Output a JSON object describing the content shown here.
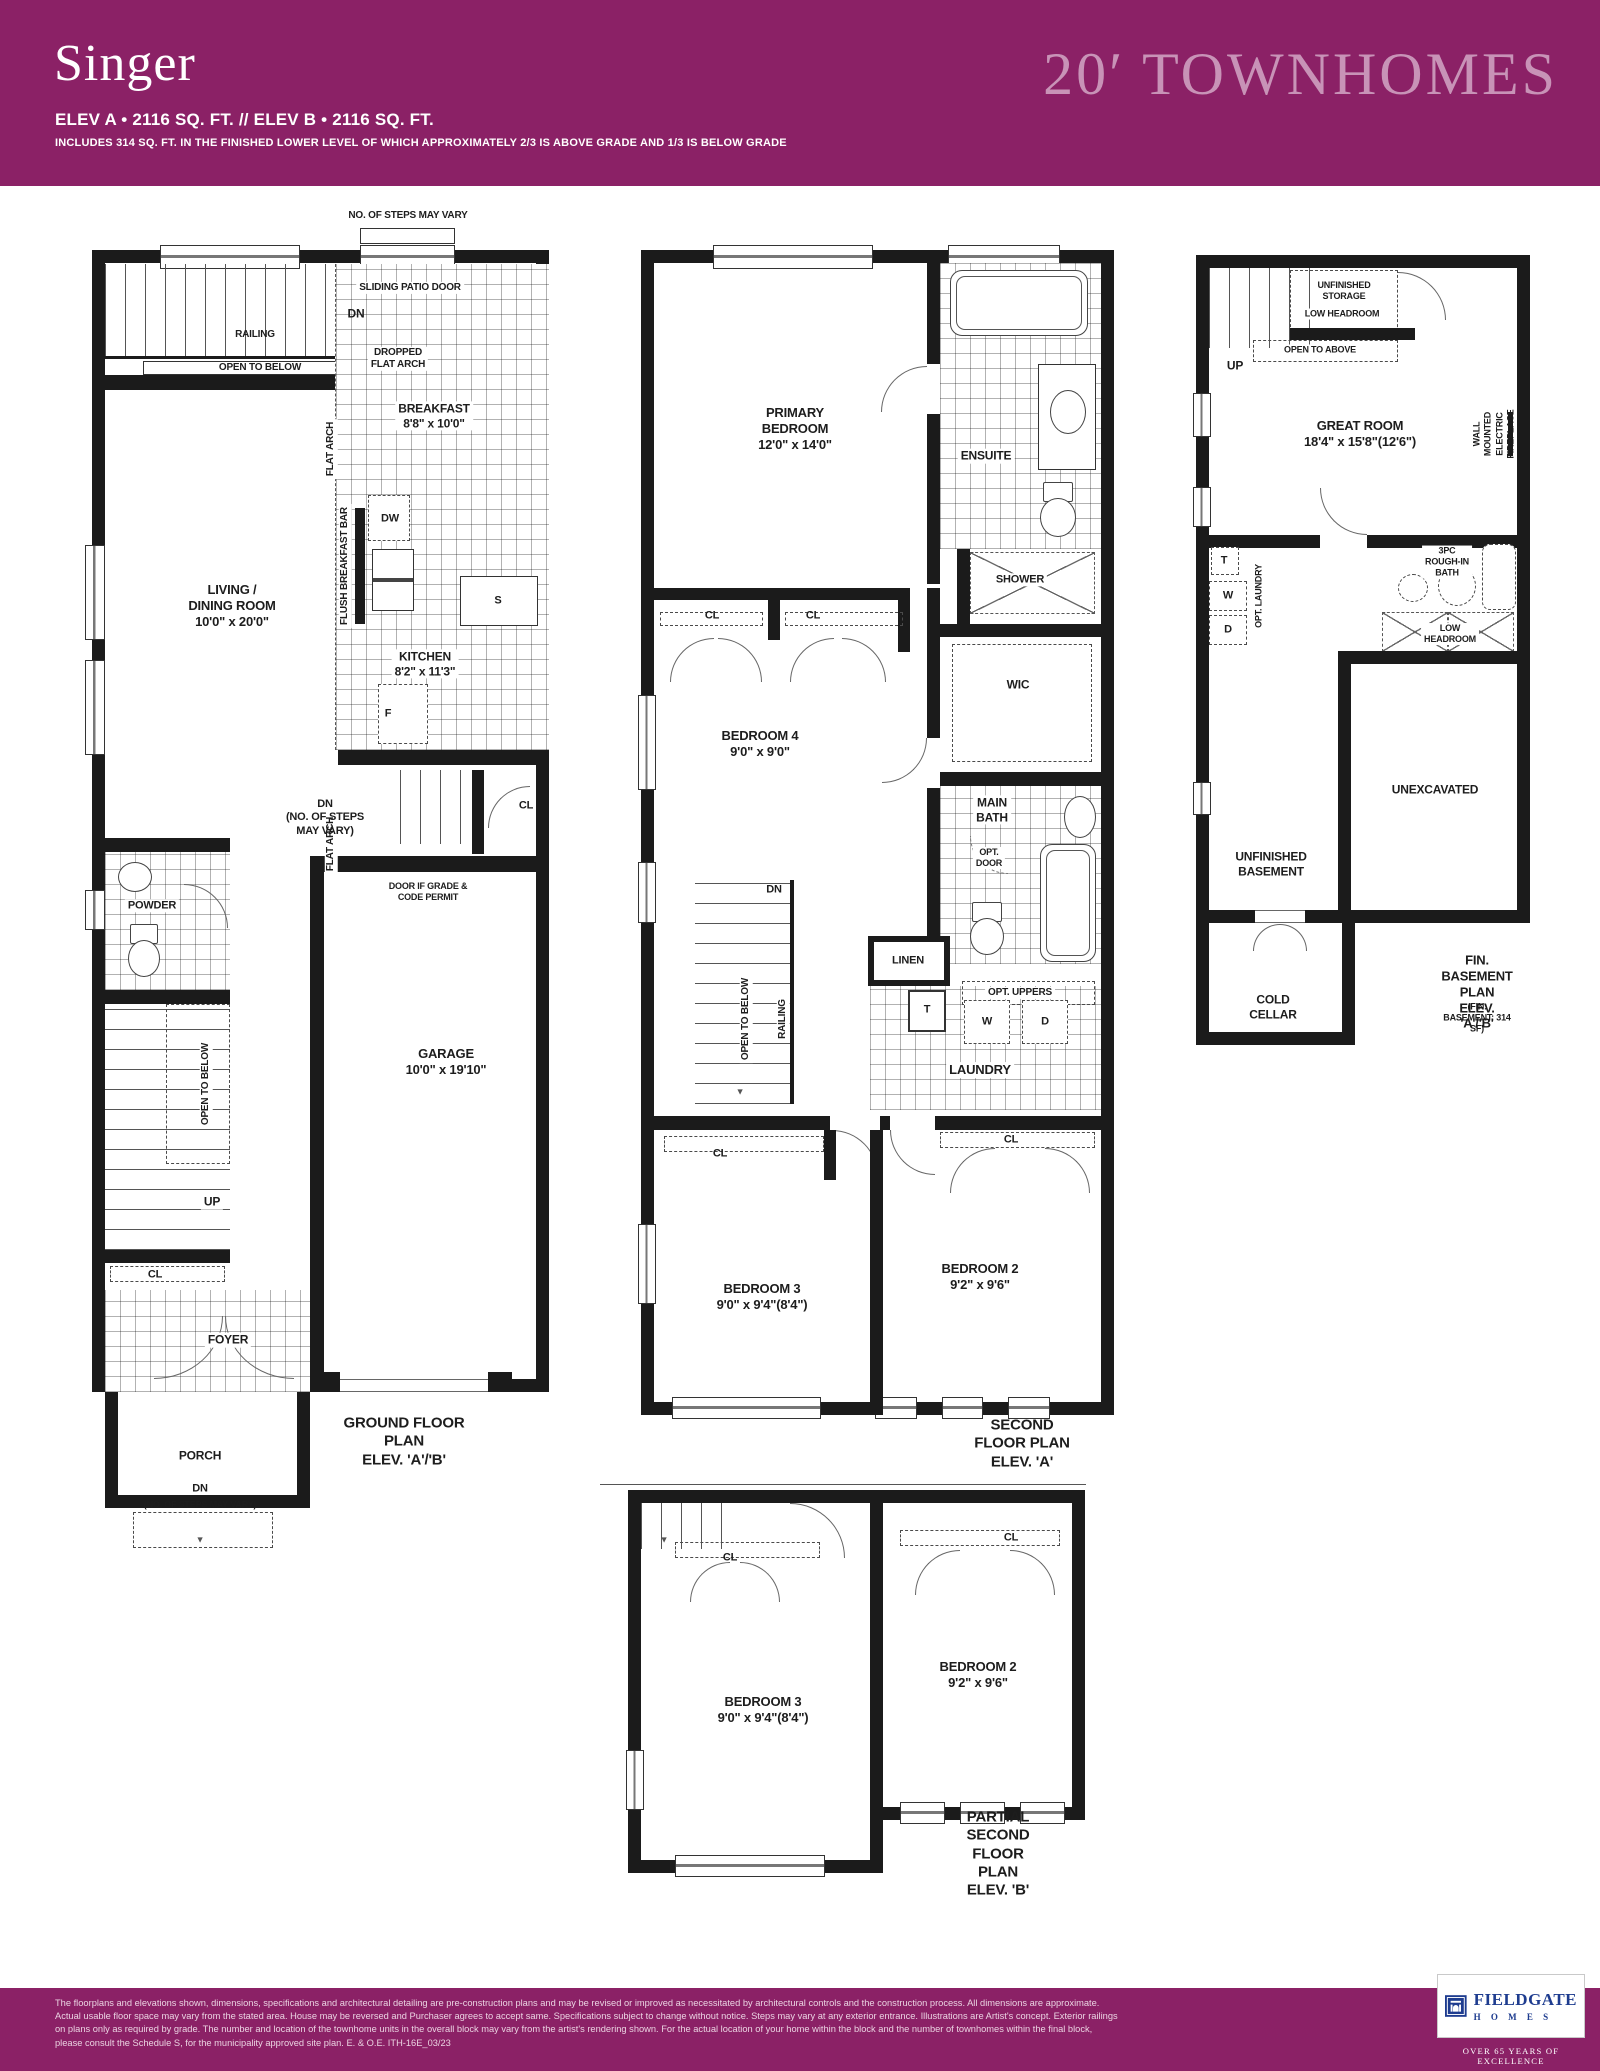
{
  "header": {
    "title": "Singer",
    "spec_line": "ELEV A • 2116 SQ. FT.  //  ELEV B • 2116 SQ. FT.",
    "note_line": "INCLUDES 314 SQ. FT. IN THE FINISHED LOWER LEVEL OF WHICH APPROXIMATELY 2/3 IS ABOVE GRADE AND 1/3 IS BELOW GRADE",
    "brand": "20′ TOWNHOMES",
    "colors": {
      "band": "#8B2166",
      "brand_text": "#C893B7",
      "title_text": "#FFFFFF"
    }
  },
  "icons": {
    "arrow_down": "▼"
  },
  "plans": {
    "ground": {
      "labels": {
        "no_steps_top": "NO. OF STEPS MAY VARY",
        "sliding_patio_door": "SLIDING PATIO DOOR",
        "dn_top": "DN",
        "railing": "RAILING",
        "open_to_below_top": "OPEN TO BELOW",
        "dropped_flat_arch": "DROPPED\nFLAT ARCH",
        "breakfast": "BREAKFAST\n8'8\" x 10'0\"",
        "flat_arch_upper": "FLAT ARCH",
        "dw": "DW",
        "flush_breakfast_bar": "FLUSH BREAKFAST BAR",
        "sink": "S",
        "kitchen": "KITCHEN\n8'2\" x 11'3\"",
        "flat_arch_lower": "FLAT ARCH",
        "fridge": "F",
        "living_dining": "LIVING /\nDINING ROOM\n10'0\" x 20'0\"",
        "dn_mid": "DN\n(NO. OF STEPS\nMAY VARY)",
        "cl_mid": "CL",
        "door_if_grade": "DOOR IF GRADE &\nCODE PERMIT",
        "powder": "POWDER",
        "garage": "GARAGE\n10'0\" x 19'10\"",
        "open_to_below_stair": "OPEN TO BELOW",
        "up": "UP",
        "cl_lower": "CL",
        "foyer": "FOYER",
        "porch": "PORCH",
        "dn_bottom": "DN",
        "dn_bottom_note": "(NO. OF STEPS MAY VARY)",
        "caption": "GROUND FLOOR PLAN\nELEV. 'A'/'B'"
      }
    },
    "second": {
      "labels": {
        "primary_bedroom": "PRIMARY\nBEDROOM\n12'0\" x 14'0\"",
        "ensuite": "ENSUITE",
        "shower": "SHOWER",
        "cl_left": "CL",
        "cl_right": "CL",
        "wic": "WIC",
        "bedroom4": "BEDROOM 4\n9'0\" x 9'0\"",
        "main_bath": "MAIN\nBATH",
        "opt_door": "OPT.\nDOOR",
        "dn": "DN",
        "linen": "LINEN",
        "open_to_below": "OPEN TO BELOW",
        "railing": "RAILING",
        "t": "T",
        "opt_uppers": "OPT. UPPERS",
        "w": "W",
        "d": "D",
        "laundry": "LAUNDRY",
        "cl_bottom_left": "CL",
        "cl_bottom_right": "CL",
        "bedroom3": "BEDROOM 3\n9'0\" x 9'4\"(8'4\")",
        "bedroom2": "BEDROOM 2\n9'2\" x 9'6\"",
        "caption": "SECOND FLOOR PLAN\nELEV. 'A'"
      }
    },
    "basement": {
      "labels": {
        "up": "UP",
        "unfinished_storage": "UNFINISHED\nSTORAGE",
        "low_headroom_storage": "LOW HEADROOM",
        "open_to_above": "OPEN TO ABOVE",
        "great_room": "GREAT ROOM\n18'4\" x 15'8\"(12'6\")",
        "fireplace": "WALL MOUNTED\nELECTRIC FIREPLACE",
        "t": "T",
        "w": "W",
        "d": "D",
        "opt_laundry": "OPT. LAUNDRY",
        "rough_in_bath": "3PC\nROUGH-IN\nBATH",
        "low_headroom": "LOW\nHEADROOM",
        "unexcavated": "UNEXCAVATED",
        "unfinished_basement": "UNFINISHED\nBASEMENT",
        "cold_cellar": "COLD\nCELLAR",
        "caption_main": "FIN. BASEMENT PLAN\nELEV. 'A'/'B'",
        "caption_note": "(FIN. BASEMENT: 314 SF)"
      }
    },
    "partial": {
      "labels": {
        "cl_left": "CL",
        "cl_right": "CL",
        "bedroom3": "BEDROOM 3\n9'0\" x 9'4\"(8'4\")",
        "bedroom2": "BEDROOM 2\n9'2\" x 9'6\"",
        "caption": "PARTIAL SECOND FLOOR PLAN\nELEV. 'B'"
      }
    }
  },
  "footer": {
    "disclaimer": "The floorplans and elevations shown, dimensions, specifications and architectural detailing are pre-construction plans and may be revised or improved as necessitated by architectural controls and the construction process. All dimensions are approximate.\nActual usable floor space may vary from the stated area. House may be reversed and Purchaser agrees to accept same. Specifications subject to change without notice. Steps may vary at any exterior entrance. Illustrations are Artist's concept. Exterior railings\non plans only as required by grade. The number and location of the townhome units in the overall block may vary from the artist's rendering shown. For the actual location of your home within the block and the number of townhomes within the final block,\nplease consult the Schedule S, for the municipality approved site plan. E. & O.E. ITH-16E_03/23",
    "logo": {
      "name": "FIELDGATE",
      "homes": "H O M E S",
      "tagline": "OVER 65 YEARS OF EXCELLENCE",
      "color": "#1E3C8F"
    }
  }
}
